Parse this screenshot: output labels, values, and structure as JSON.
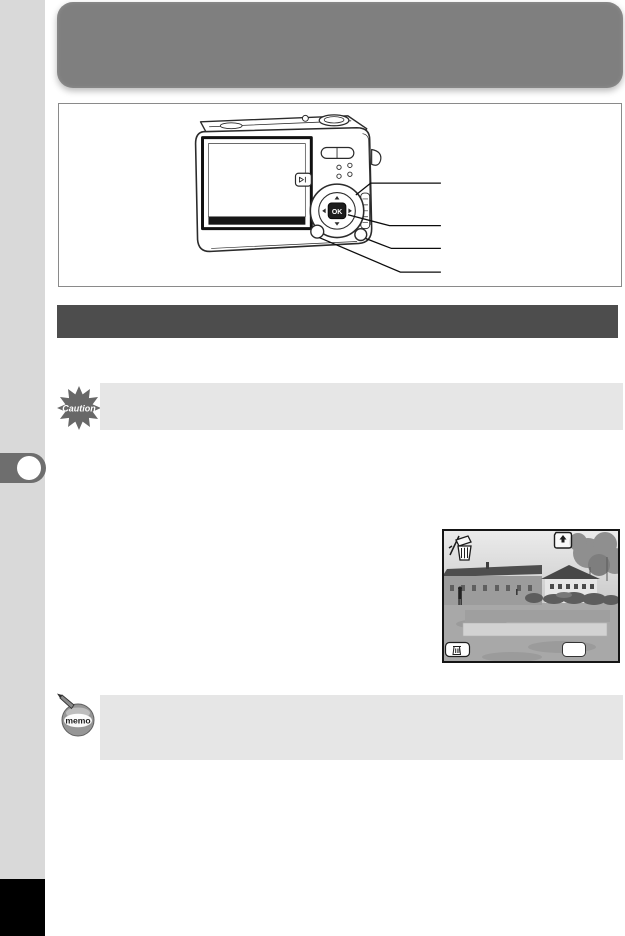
{
  "page": {
    "kind": "camera-manual-page",
    "background": "#ffffff"
  },
  "colors": {
    "header_banner": "#7f7f7f",
    "section_bar": "#4d4d4d",
    "note_box": "#e6e6e6",
    "sidebar_strip": "#d9d9d9",
    "chapter_tab": "#6e6e6e",
    "footer_block": "#000000"
  },
  "header": {
    "title": ""
  },
  "section": {
    "title": ""
  },
  "caution": {
    "icon_label": "Caution",
    "text": ""
  },
  "memo": {
    "icon_label": "memo",
    "text": ""
  },
  "camera_diagram": {
    "ok_button_label": "OK",
    "callouts": [
      "",
      "",
      "",
      ""
    ],
    "parts": [
      "four-way-controller",
      "ok-button",
      "fn-button",
      "menu-button",
      "zoom-rocker",
      "playback-button",
      "shutter-button",
      "lcd-monitor",
      "speaker-holes",
      "strap-lug"
    ]
  },
  "lcd_screen": {
    "status_icons": [
      "delete-icon",
      "memory-card-icon"
    ],
    "menu_options": [
      "",
      ""
    ],
    "soft_buttons": [
      {
        "name": "trash-soft-button",
        "icon": "trash-icon",
        "label": ""
      },
      {
        "name": "ok-soft-button",
        "label": ""
      }
    ]
  }
}
